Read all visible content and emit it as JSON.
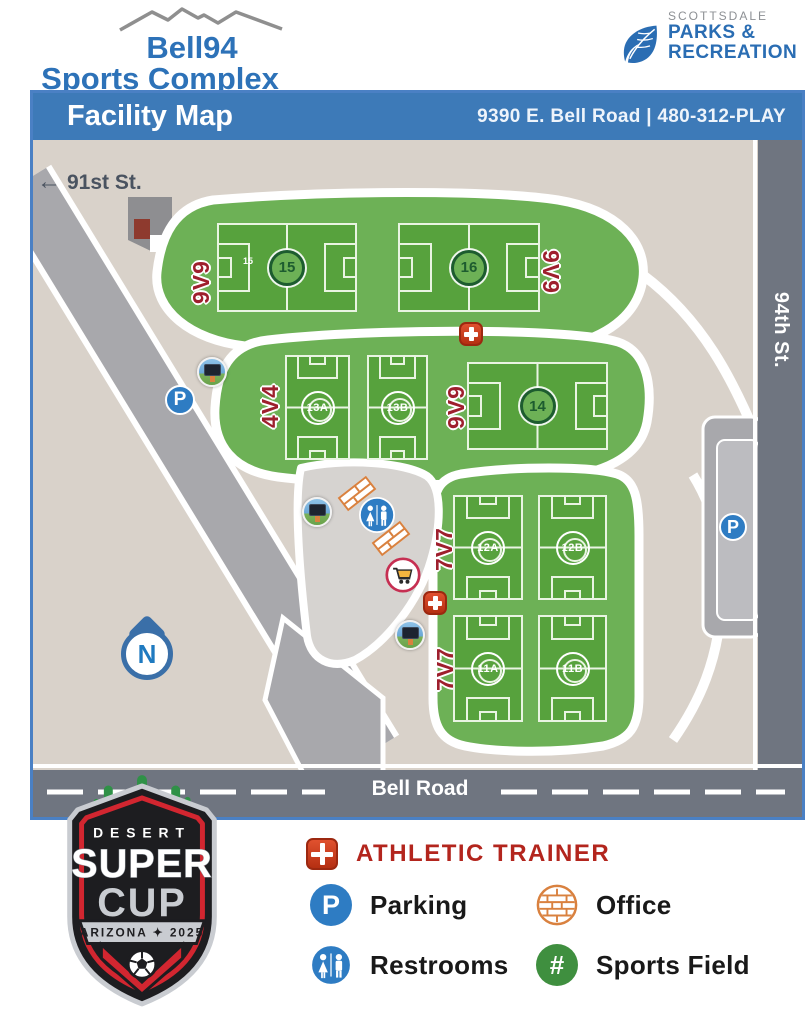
{
  "header": {
    "logo_line1": "Bell94",
    "logo_line2": "Sports Complex",
    "scottsdale_small": "SCOTTSDALE",
    "scottsdale_line1": "PARKS &",
    "scottsdale_line2": "RECREATION"
  },
  "banner": {
    "title": "Facility Map",
    "address": "9390 E. Bell Road | 480-312-PLAY"
  },
  "map": {
    "streets": {
      "s91": "91st St.",
      "s94": "94th St.",
      "bell": "Bell Road"
    },
    "north": "N",
    "group_labels": {
      "g15": "9V9",
      "g16": "9V9",
      "g13": "4V4",
      "g14": "9V9",
      "g12": "7V7",
      "g11": "7V7"
    },
    "fields": {
      "f15": "15",
      "f15_small": "15",
      "f16": "16",
      "f13a": "13A",
      "f13b": "13B",
      "f14": "14",
      "f12a": "12A",
      "f12b": "12B",
      "f11a": "11A",
      "f11b": "11B"
    }
  },
  "glyphs": {
    "parking": "P",
    "hash": "#",
    "arrow": "←"
  },
  "legend": {
    "athletic_trainer": "ATHLETIC TRAINER",
    "parking": "Parking",
    "office": "Office",
    "restrooms": "Restrooms",
    "sports_field": "Sports Field"
  },
  "badge": {
    "desert": "DESERT",
    "superword": "SUPER",
    "cup": "CUP",
    "banner": "ARIZONA ✦ 2025"
  },
  "colors": {
    "brand_blue": "#2d72b8",
    "banner_blue": "#3d7ab8",
    "scottsdale_blue": "#2a6db3",
    "map_bg": "#d9d2ca",
    "green_area": "#6db156",
    "field_green": "#57a23d",
    "field_dark_green": "#1d5c2f",
    "label_maroon": "#9e1f2d",
    "trainer_red": "#cf3a1c",
    "parking_blue": "#2e7cc3",
    "office_orange": "#d9813f",
    "sports_field_green": "#3f8f3f",
    "road_dark": "#6f7580",
    "road_light": "#a8a8ac",
    "legend_red_text": "#b3251d",
    "badge_red": "#d22630",
    "badge_silver": "#c9ccd1"
  }
}
